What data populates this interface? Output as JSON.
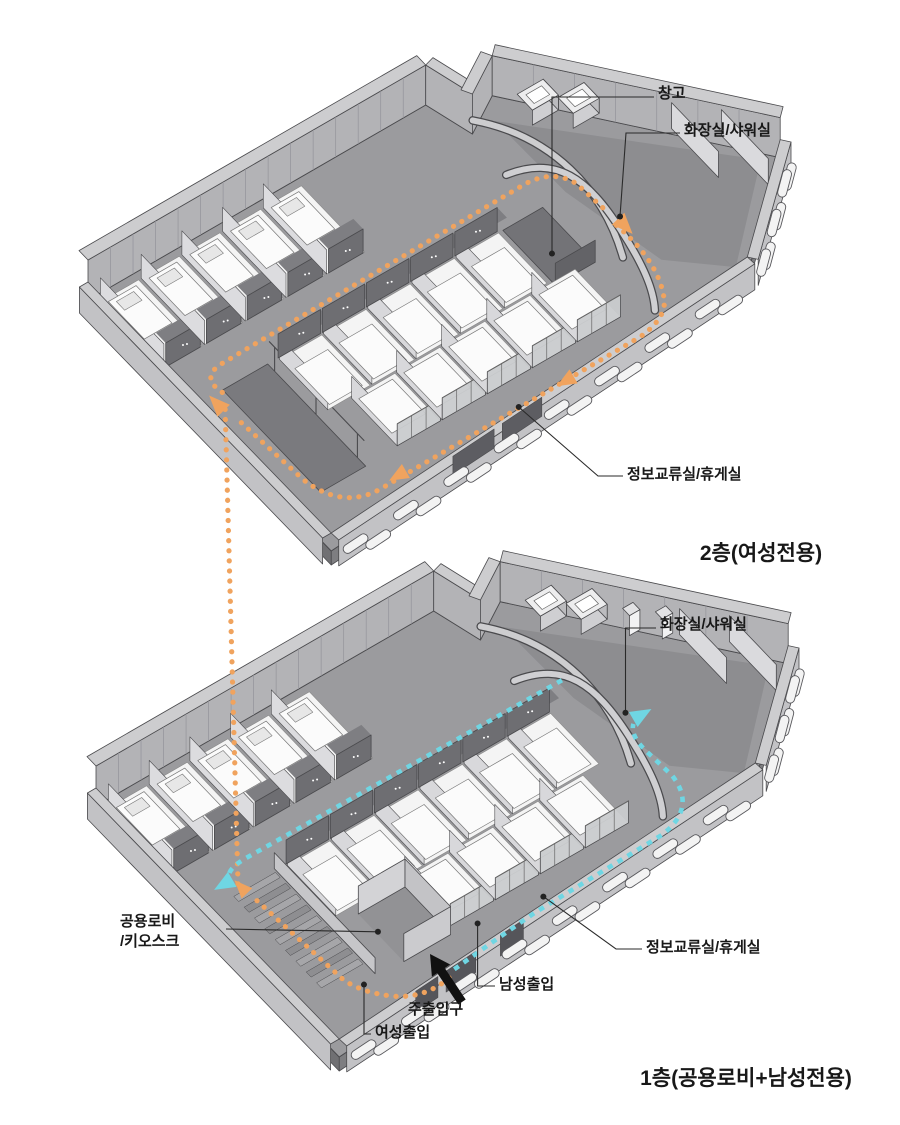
{
  "diagram": {
    "floor2": {
      "title": "2층(여성전용)",
      "labels": {
        "storage": "창고",
        "bathroom": "화장실/샤워실",
        "lounge": "정보교류실/휴게실"
      }
    },
    "floor1": {
      "title": "1층(공용로비+남성전용)",
      "labels": {
        "bathroom": "화장실/샤워실",
        "lobby_line1": "공용로비",
        "lobby_line2": "/키오스크",
        "lounge": "정보교류실/휴게실",
        "men_entrance": "남성출입",
        "main_entrance": "주출입구",
        "women_entrance": "여성출입"
      }
    },
    "path_colors": {
      "female_route": "#F0A35E",
      "male_route": "#6FD6E3"
    }
  },
  "colors": {
    "orange": "#F0A35E",
    "cyan": "#6FD6E3",
    "wallTop": "#cdcdcf",
    "wallFace": "#b3b3b6",
    "floor": "#9b9b9e",
    "floorDark": "#8d8d90",
    "slabEdge": "#7e7e81",
    "dark": "#6e6e72",
    "cell": "#f4f4f4",
    "bed": "#fbfbfb",
    "pillow": "#e7e7e7",
    "glass": "#c9cbcd",
    "block": "#f3f3f3",
    "line": "#4a4a4d",
    "label": "#181818",
    "arrowBlack": "#111111"
  }
}
